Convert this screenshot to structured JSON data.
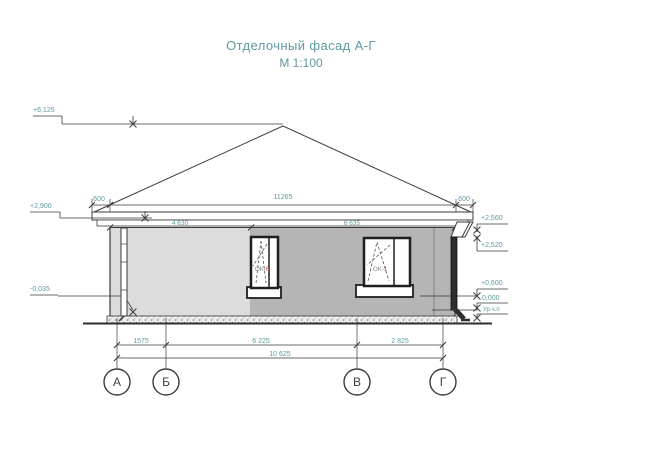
{
  "drawing": {
    "title": "Отделочный фасад А-Г",
    "scale": "М 1:100"
  },
  "elevation_marks": {
    "ridge": "+6,125",
    "eave": "+2,900",
    "blind_area": "-0,035",
    "fascia_top": "+2,560",
    "fascia_bottom": "+2,520",
    "window_sill": "+0,600",
    "floor": "0,000",
    "floor_note": "Ур.ч.п"
  },
  "dimensions": {
    "top": {
      "left_overhang": "600",
      "building_span": "11265",
      "right_overhang": "600"
    },
    "wall": {
      "left_segment": "4 630",
      "right_segment": "6 635"
    },
    "bottom": {
      "a_b": "1575",
      "b_v": "6 225",
      "v_g": "2 825",
      "total": "10 625"
    }
  },
  "axes": [
    {
      "label": "А"
    },
    {
      "label": "Б"
    },
    {
      "label": "В"
    },
    {
      "label": "Г"
    }
  ],
  "windows": [
    {
      "prefix": "ОК",
      "suffix": "-6"
    },
    {
      "prefix": "ОК",
      "suffix": "-1"
    }
  ],
  "colors": {
    "accent": "#5e9aa2",
    "line": "#3a3a3a",
    "wall_light": "#dcdcdc",
    "wall_dark": "#b5b5b5",
    "window_tag": "#c2574a"
  }
}
